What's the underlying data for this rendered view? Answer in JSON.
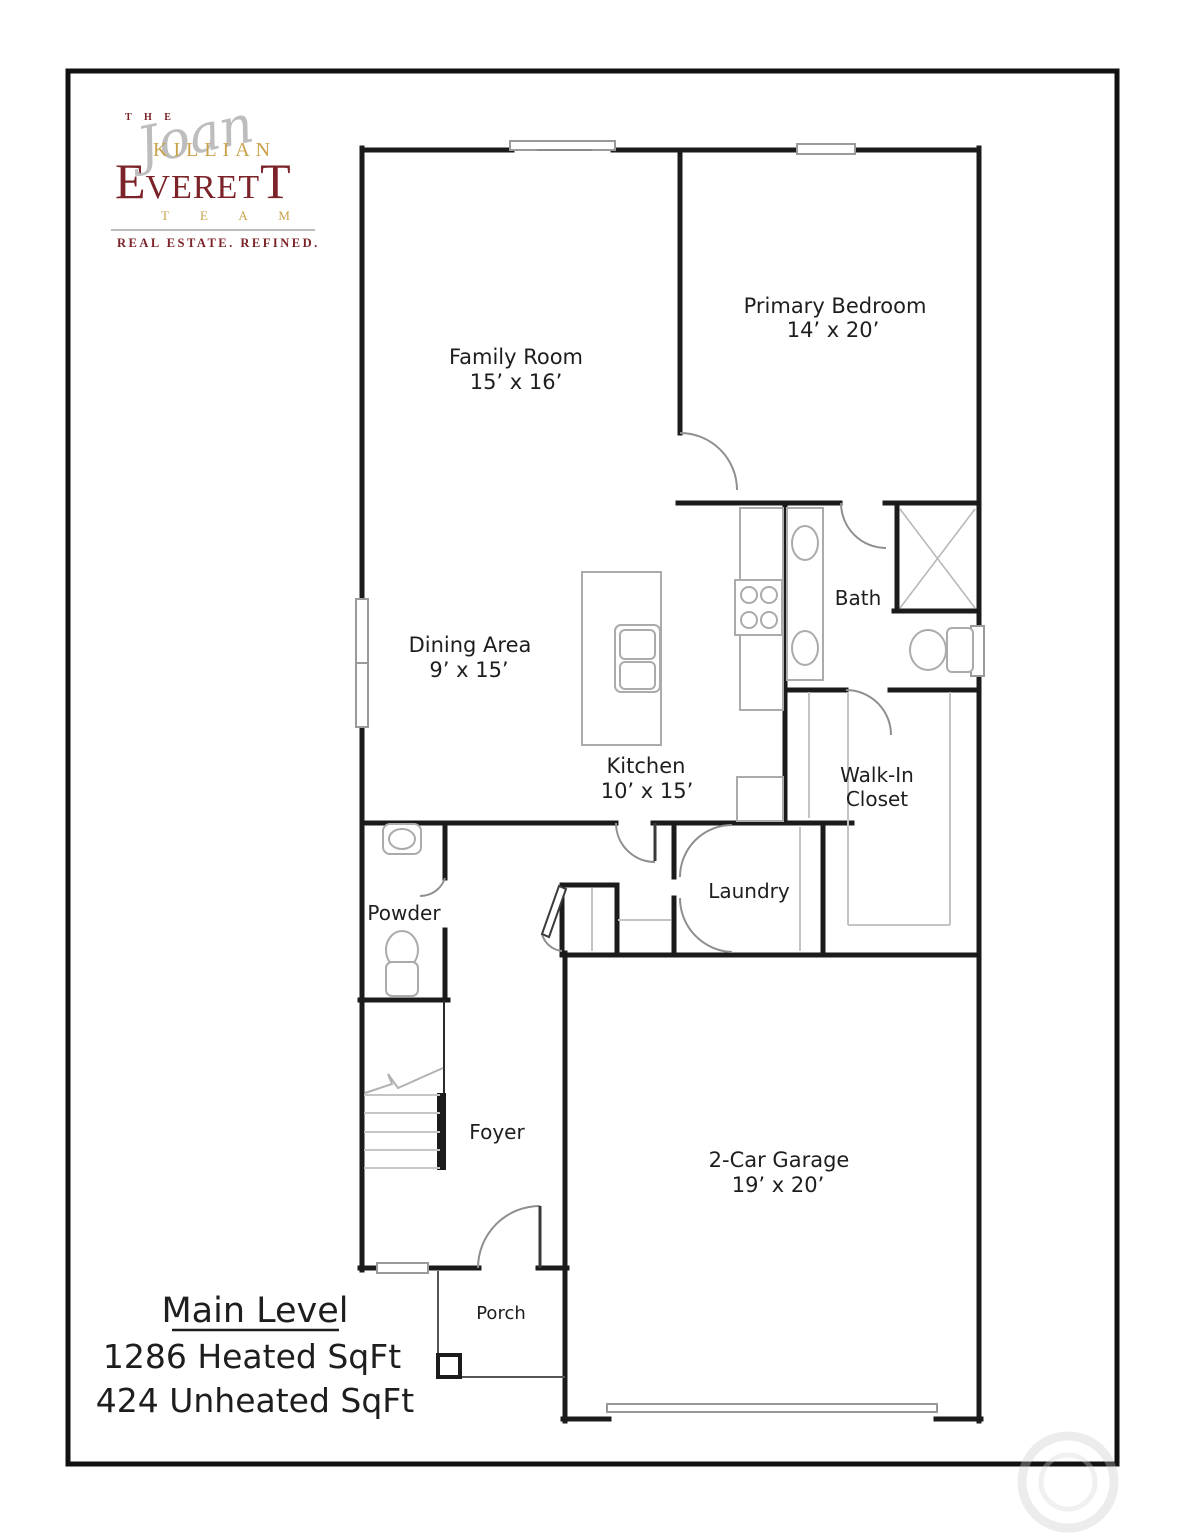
{
  "logo": {
    "the": "T H E",
    "script_name": "Joan",
    "killian": "KILLIAN",
    "everett_first": "E",
    "everett_mid": "VERET",
    "everett_last": "T",
    "team": "T E A M",
    "tagline": "REAL ESTATE. REFINED.",
    "maroon": "#7b2328",
    "gold": "#c9a24a",
    "script_gray": "#bdbdbd"
  },
  "rooms": {
    "family_room": {
      "name": "Family Room",
      "dims": "15’ x 16’"
    },
    "primary_bedroom": {
      "name": "Primary Bedroom",
      "dims": "14’ x 20’"
    },
    "dining_area": {
      "name": "Dining Area",
      "dims": "9’ x 15’"
    },
    "kitchen": {
      "name": "Kitchen",
      "dims": "10’ x 15’"
    },
    "bath": {
      "name": "Bath"
    },
    "walk_in_closet": {
      "line1": "Walk-In",
      "line2": "Closet"
    },
    "laundry": {
      "name": "Laundry"
    },
    "powder": {
      "name": "Powder"
    },
    "foyer": {
      "name": "Foyer"
    },
    "garage": {
      "name": "2-Car Garage",
      "dims": "19’ x 20’"
    },
    "porch": {
      "name": "Porch"
    }
  },
  "summary": {
    "level": "Main Level",
    "heated": "1286 Heated SqFt",
    "unheated": "424 Unheated SqFt"
  }
}
